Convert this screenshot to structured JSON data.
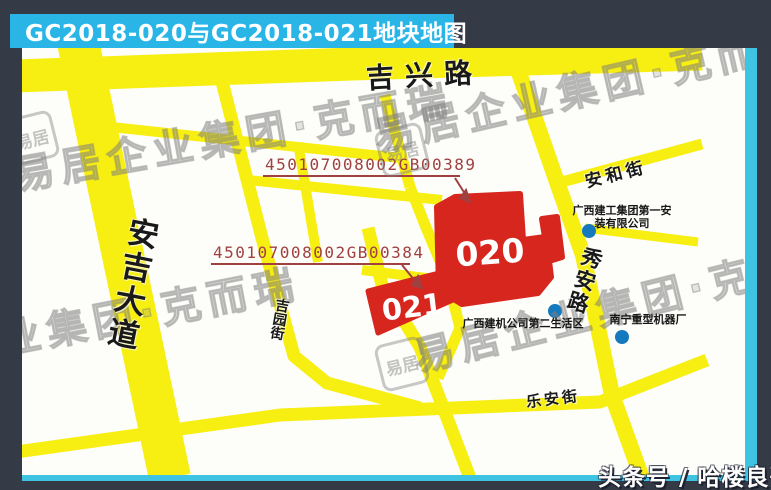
{
  "title": {
    "text": "GC2018-020与GC2018-021地块地图"
  },
  "map": {
    "roads": {
      "jixing": "吉兴路",
      "anji": "安吉大道",
      "jiyuan": "吉园街",
      "xiuan": "秀安路",
      "anhe": "安和街",
      "lean": "乐安街"
    },
    "parcels": [
      {
        "id": "020",
        "code": "450107008002GB00389"
      },
      {
        "id": "021",
        "code": "450107008002GB00384"
      }
    ],
    "pois": [
      {
        "name_line1": "广西建工集团第一安",
        "name_line2": "装有限公司"
      },
      {
        "name_line1": "广西建机公司第二生活区",
        "name_line2": ""
      },
      {
        "name_line1": "南宁重型机器厂",
        "name_line2": ""
      }
    ],
    "watermark": {
      "text": "易居企业集团·克而瑞",
      "seal_text": "易居"
    }
  },
  "footer": {
    "badge": "头条号 / 哈楼良哥"
  },
  "colors": {
    "background": "#353a47",
    "title_bar": "#29b5e6",
    "road_yellow": "#f7ee12",
    "parcel_red": "#d7261d",
    "code_red": "#a04040",
    "poi_dot_blue": "#1579bd",
    "edge_cyan": "#3fc3e2"
  }
}
